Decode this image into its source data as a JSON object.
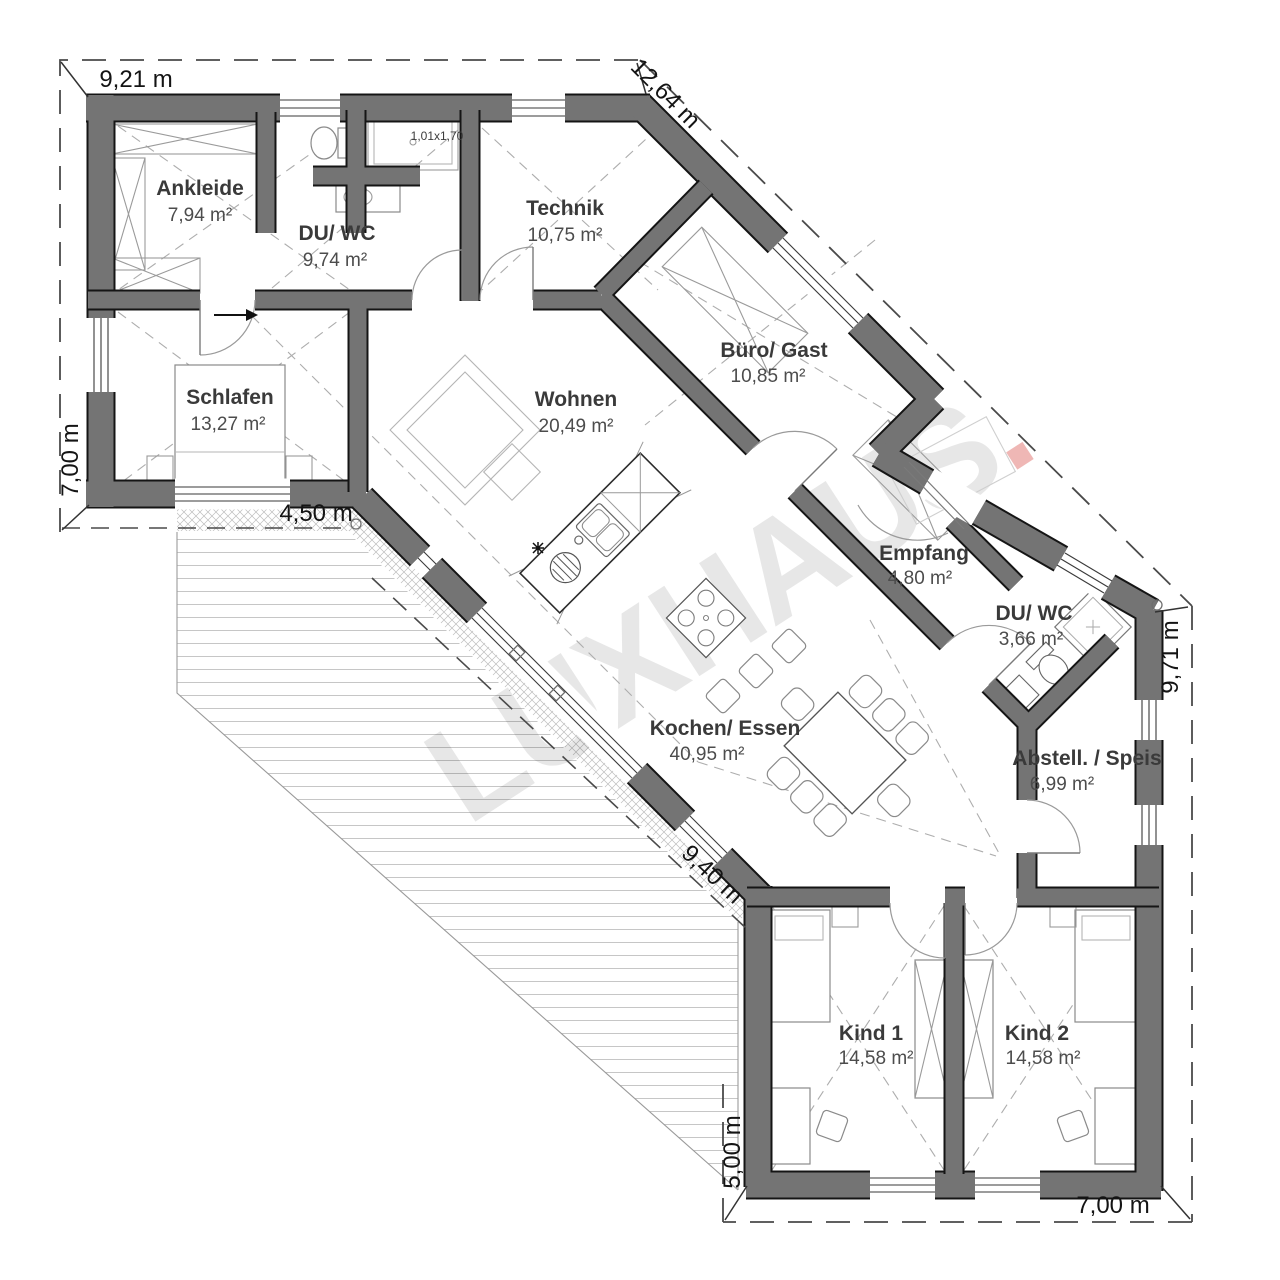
{
  "watermark": {
    "text": "LUXHAUS",
    "dot": "."
  },
  "rooms": [
    {
      "name": "Ankleide",
      "area": "7,94 m²"
    },
    {
      "name": "DU/ WC",
      "area": "9,74 m²"
    },
    {
      "name": "Technik",
      "area": "10,75 m²"
    },
    {
      "name": "Büro/ Gast",
      "area": "10,85 m²"
    },
    {
      "name": "Schlafen",
      "area": "13,27 m²"
    },
    {
      "name": "Wohnen",
      "area": "20,49 m²"
    },
    {
      "name": "Empfang",
      "area": "4,80 m²"
    },
    {
      "name": "DU/ WC",
      "area": "3,66 m²"
    },
    {
      "name": "Kochen/ Essen",
      "area": "40,95 m²"
    },
    {
      "name": "Abstell. / Speis",
      "area": "6,99 m²"
    },
    {
      "name": "Kind 1",
      "area": "14,58 m²"
    },
    {
      "name": "Kind 2",
      "area": "14,58 m²"
    }
  ],
  "dimensions": {
    "top": "9,21 m",
    "diag_top_right": "12,64 m",
    "left": "7,00 m",
    "terrace_top": "4,50 m",
    "right": "9,71 m",
    "terrace_diag": "9,40 m",
    "bottom_wing_left": "5,00 m",
    "bottom": "7,00 m"
  },
  "annotations": {
    "shower_size": "1,01x1,70"
  },
  "colors": {
    "wall": "#747474",
    "watermark_dot": "#d9534f"
  }
}
